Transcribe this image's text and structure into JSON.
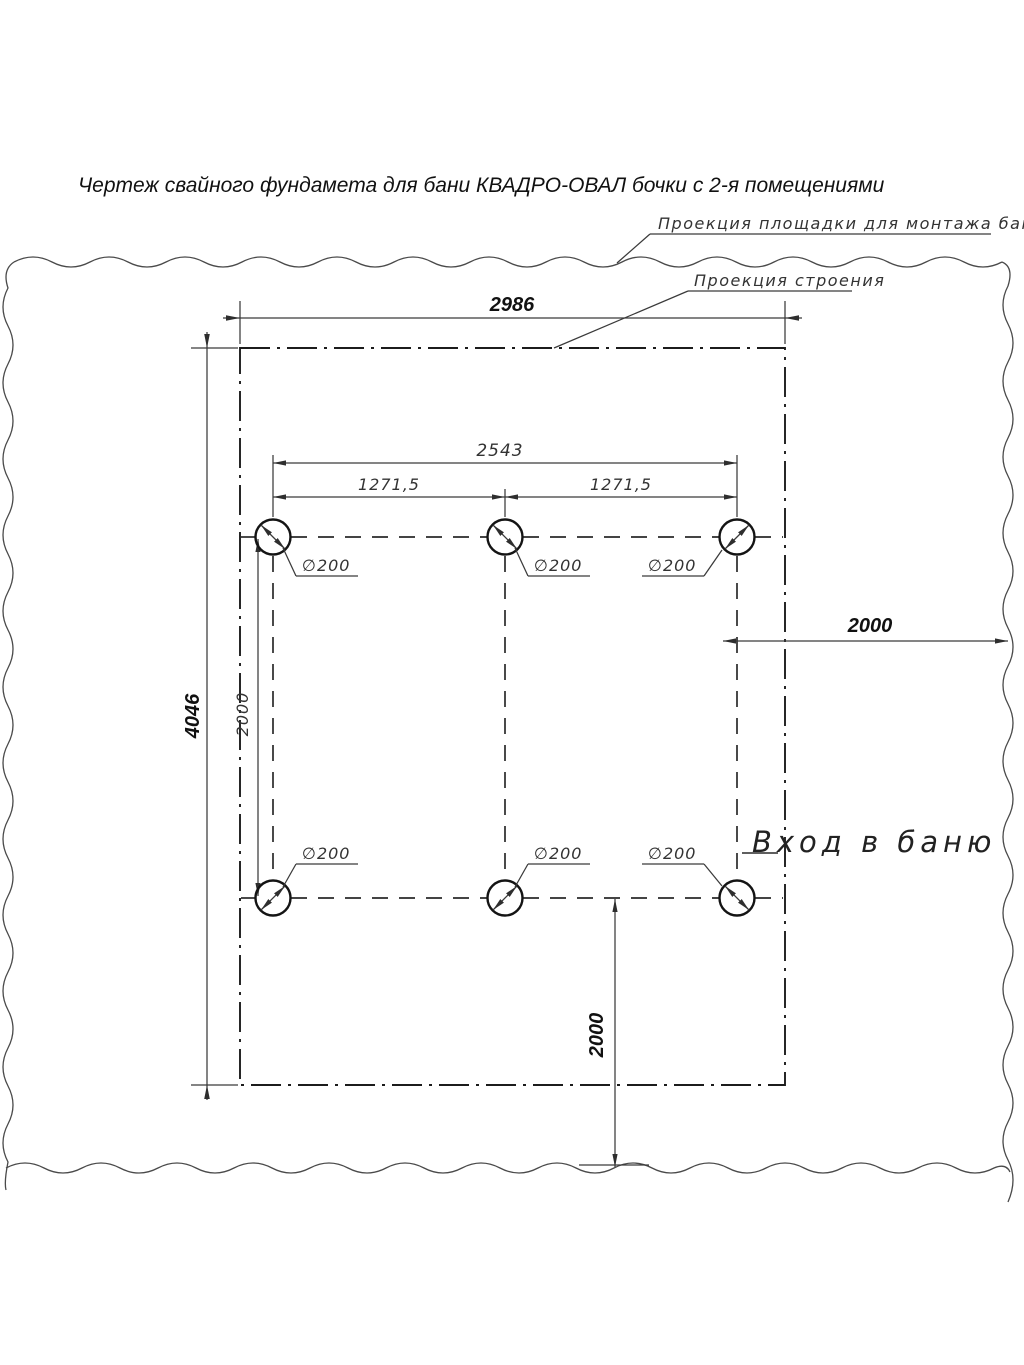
{
  "title": "Чертеж свайного фундамета для бани КВАДРО-ОВАЛ бочки с 2-я помещениями",
  "callouts": {
    "platform": "Проекция площадки для монтажа бани",
    "building": "Проекция строения"
  },
  "entrance_label": "Вход в баню",
  "dimensions": {
    "platform_width": "2986",
    "platform_height": "4046",
    "pile_span_total": "2543",
    "pile_span_left": "1271,5",
    "pile_span_right": "1271,5",
    "pile_row_spacing": "2000",
    "entrance_offset": "2000",
    "bottom_offset": "2000",
    "pile_diameters": [
      "∅200",
      "∅200",
      "∅200",
      "∅200",
      "∅200",
      "∅200"
    ]
  }
}
